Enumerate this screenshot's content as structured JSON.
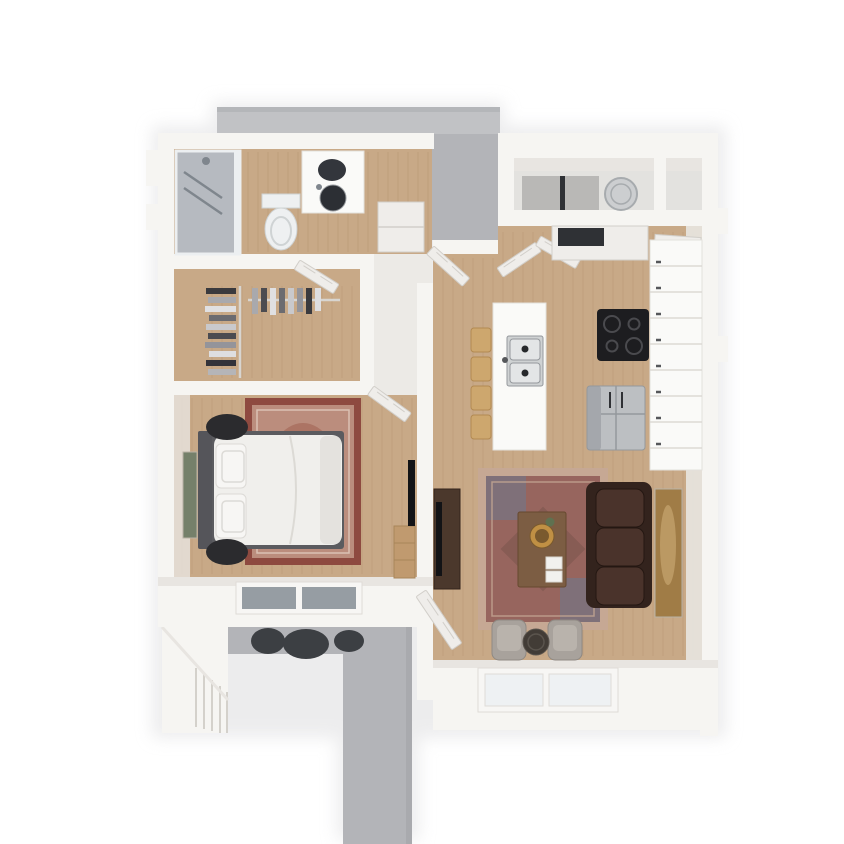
{
  "scene": {
    "width": 844,
    "height": 844,
    "background": "#ffffff",
    "description": "3D rendered top-down floor plan of a one-bedroom apartment with bedroom, walk-in closet, bathroom, kitchen with island, living room, entry utility closet, concrete walkway and balcony"
  },
  "areas": {
    "walkway": "concrete-walkway",
    "balcony": "balcony",
    "bathroom": "bathroom",
    "closet": "walk-in-closet",
    "bedroom": "bedroom",
    "hallway": "hallway",
    "kitchen": "kitchen",
    "living_room": "living-room",
    "entry": "entry-utility-closet"
  },
  "furniture": {
    "bed": "queen-bed-white-duvet",
    "poufs": "round-black-poufs",
    "bedroom_rug": "red-oriental-rug",
    "dresser": "wood-dresser",
    "bedroom_tv": "wall-tv-bedroom",
    "sofa": "dark-leather-sofa",
    "living_rug": "red-blue-oriental-rug",
    "coffee_table": "wood-coffee-table-with-gold-tray",
    "accent_chairs": "gray-swivel-chairs",
    "side_table": "round-dark-side-table",
    "tv_console": "tv-console",
    "island": "kitchen-island-double-sink",
    "stools": "wood-bar-stools",
    "cooktop": "black-cooktop",
    "fridge": "stainless-fridge",
    "water_heater": "water-heater",
    "toilet": "toilet",
    "vanity": "vanity-round-sink",
    "shower": "glass-shower",
    "clothes_rack": "hanging-clothes",
    "balcony_set": "balcony-bistro-set"
  },
  "palette": {
    "page_bg": "#ffffff",
    "shadow": "#dedee0",
    "concrete": "#b3b4b8",
    "concrete_light": "#c1c2c5",
    "concrete_edge": "#9fa0a4",
    "wall": "#f6f5f2",
    "wall_shade": "#e8e5e1",
    "wall_dark": "#d4d1cb",
    "floor_pale": "#eceae6",
    "wood": "#c8a987",
    "wood_line": "#b2906d",
    "rug_bd_border": "#8e4a40",
    "rug_bd_field": "#bb8d7d",
    "rug_bd_center": "#a5695a",
    "rug_bd_line": "#e3cfc0",
    "rug_lv_border": "#c6a894",
    "rug_lv_field": "#97655e",
    "rug_lv_blue": "#6c7a90",
    "rug_lv_center": "#7d564e",
    "sofa_base": "#33231d",
    "sofa_cushion": "#4a332b",
    "sofa_edge": "#241712",
    "chair": "#a8a29c",
    "chair_dark": "#8f8983",
    "chair_seat": "#b9b3ac",
    "side_table": "#423c36",
    "side_table_rim": "#5a544d",
    "table_wood": "#7c5d43",
    "table_edge": "#66492f",
    "tray_gold": "#c09044",
    "tray_inner": "#7a5a2e",
    "plant": "#5f7150",
    "book": "#f2f1ee",
    "book_edge": "#d9d6d0",
    "console": "#4b382c",
    "console_edge": "#33241b",
    "tv_black": "#121316",
    "dresser": "#c09a6f",
    "dresser_edge": "#a8855a",
    "headboard": "#55555a",
    "bed_frame": "#5b5b5f",
    "bed_white": "#f0efec",
    "bed_fold": "#dcdad5",
    "pillow": "#f7f6f4",
    "pillow_edge": "#dcdad6",
    "blanket": "#e4e2de",
    "pouf": "#2b2b2e",
    "art_green": "#75806a",
    "art_gold": "#a07c46",
    "art_gold_hi": "#c2a06a",
    "art_frame": "#b9b2a6",
    "door": "#efedea",
    "door_edge": "#d2cfca",
    "glass_dark": "#969da3",
    "glass_light": "#eef1f3",
    "window_frame": "#f7f6f4",
    "window_edge": "#dfdcd7",
    "shower_glass": "#b4bcc4",
    "shower_frame": "#eceff1",
    "fixture": "#7f868d",
    "toilet_body": "#eef0f1",
    "toilet_edge": "#cfd3d4",
    "mirror_dark": "#33363c",
    "sink_dark": "#2c2f34",
    "steel": "#bcbfc2",
    "steel_dark": "#94989c",
    "island": "#fafaf8",
    "island_edge": "#e3e1dc",
    "sink_steel": "#cfd2d3",
    "sink_basin": "#e3e5e6",
    "drain": "#26282b",
    "stool": "#cda76e",
    "stool_dark": "#b28a52",
    "cooktop": "#1d1d20",
    "burner": "#4a4a4e",
    "counter_line": "#dcd9d4",
    "knob": "#55575a",
    "heater": "#ccced0",
    "heater_edge": "#a7abae",
    "slot_dark": "#2f3135",
    "entry_floor": "#e3e2df",
    "entry_panel": "#b9b8b6",
    "balcony_dark": "#3c3f43",
    "rod": "#d8d5d0",
    "clothes": [
      "#3a3a3e",
      "#a9a9ad",
      "#e0e0e2",
      "#6b6b70",
      "#c9c9cc",
      "#4b4b50",
      "#94949a",
      "#dedee0",
      "#33333a",
      "#b5b5b8"
    ]
  }
}
